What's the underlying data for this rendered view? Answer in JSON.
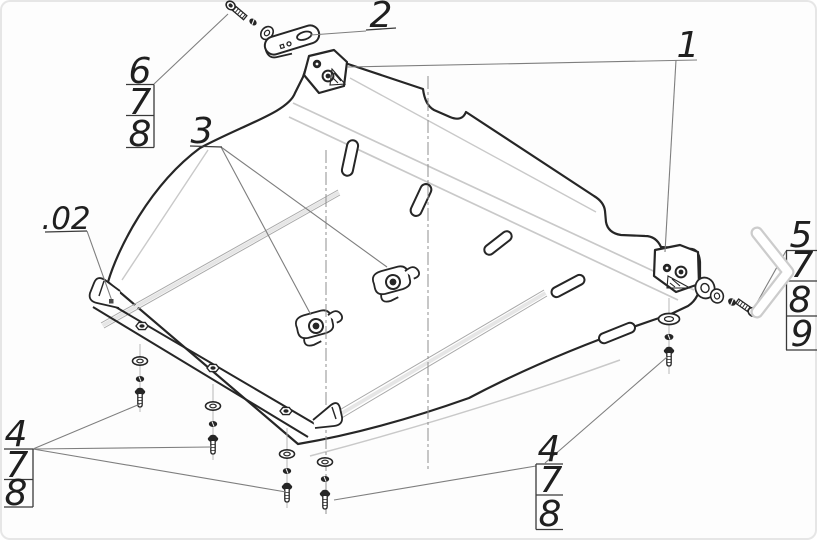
{
  "drawing": {
    "type": "exploded-assembly-technical-drawing",
    "subject": "engine skid plate with mounting hardware",
    "colors": {
      "background": "#fdfdfd",
      "main_line": "#262626",
      "bend_line": "#c9c9c9",
      "leader_line": "#7e7e7e",
      "label_line": "#3a3a3a",
      "chevron_outline": "#cccccc",
      "chevron_fill": "#ffffff"
    },
    "callouts": {
      "plate": "1",
      "bracket": "2",
      "clamp": "3",
      "subassembly": ".02",
      "top_left_stack": [
        "6",
        "7",
        "8"
      ],
      "right_stack": [
        "5",
        "7",
        "8",
        "9"
      ],
      "bottom_left_stack": [
        "4",
        "7",
        "8"
      ],
      "bottom_right_stack": [
        "4",
        "7",
        "8"
      ]
    }
  }
}
